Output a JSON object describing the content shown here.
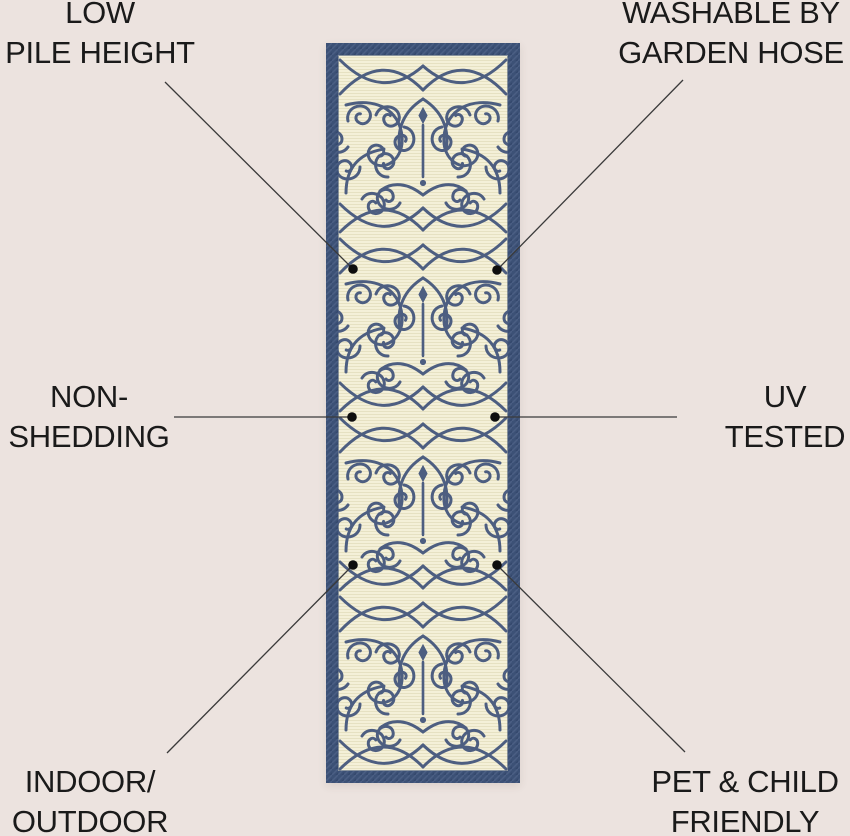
{
  "colors": {
    "background": "#ece3df",
    "label_text": "#1a1a1a",
    "connector_line": "#3a3a3a",
    "dot": "#0e0e0e",
    "rug_border": "#3c5176",
    "rug_field": "#f4f0d8",
    "rug_pattern": "#47597e"
  },
  "rug": {
    "description": "vertical runner rug, navy blue denim-textured border, ivory ribbed field, ornate navy wrought-iron scrollwork pattern"
  },
  "callouts": [
    {
      "id": "low-pile-height",
      "lines": [
        "LOW",
        "PILE HEIGHT"
      ]
    },
    {
      "id": "washable-by-garden-hose",
      "lines": [
        "WASHABLE BY",
        "GARDEN HOSE"
      ]
    },
    {
      "id": "non-shedding",
      "lines": [
        "NON-",
        "SHEDDING"
      ]
    },
    {
      "id": "uv-tested",
      "lines": [
        "UV",
        "TESTED"
      ]
    },
    {
      "id": "indoor-outdoor",
      "lines": [
        "INDOOR/",
        "OUTDOOR"
      ]
    },
    {
      "id": "pet-child-friendly",
      "lines": [
        "PET & CHILD",
        "FRIENDLY"
      ]
    }
  ]
}
